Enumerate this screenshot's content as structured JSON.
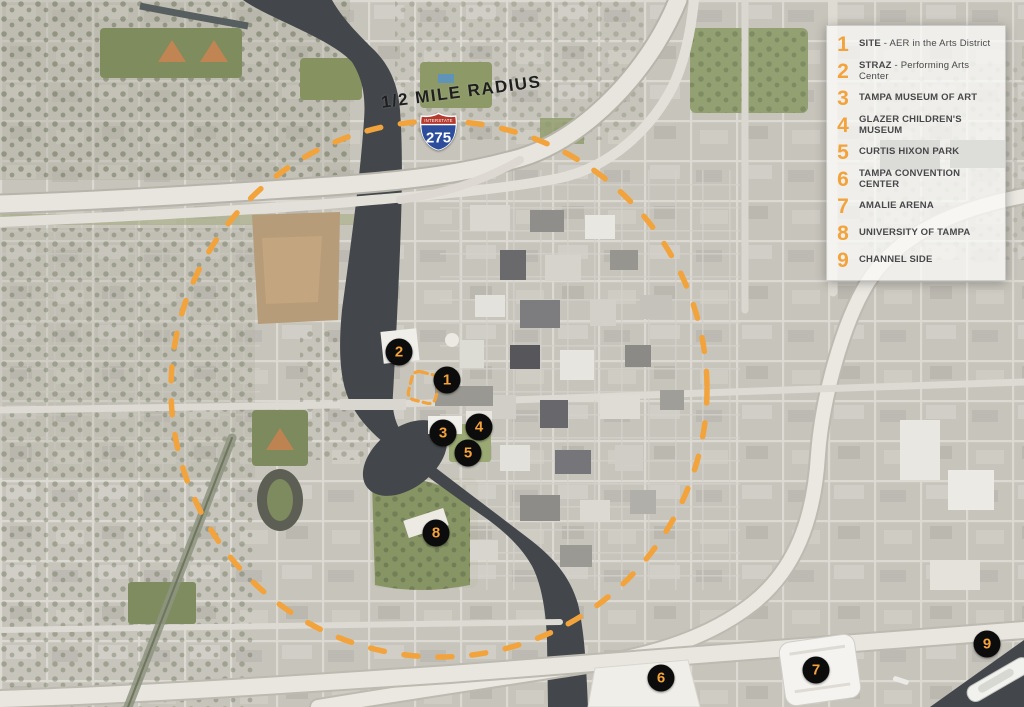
{
  "title": "Tampa downtown aerial context map - 1/2 mile radius site analysis",
  "colors": {
    "accent": "#F2A33C",
    "marker_background": "#0c0c0c",
    "water": "#43474b",
    "shield_red": "#b5392d",
    "shield_blue": "#2c4d9c",
    "legend_text": "#48484b"
  },
  "overlay": {
    "radius_label": "1/2 MILE RADIUS",
    "shield": {
      "top_text": "INTERSTATE",
      "number": "275"
    },
    "circle": {
      "cx": 439,
      "cy": 389,
      "r": 268,
      "color": "#F2A33C"
    },
    "site_box": {
      "x": 410,
      "y": 373,
      "w": 28,
      "h": 29,
      "rotation": 14,
      "color": "#F2A33C"
    }
  },
  "markers": [
    {
      "n": "1",
      "x": 447,
      "y": 380
    },
    {
      "n": "2",
      "x": 399,
      "y": 352
    },
    {
      "n": "3",
      "x": 443,
      "y": 433
    },
    {
      "n": "4",
      "x": 479,
      "y": 427
    },
    {
      "n": "5",
      "x": 468,
      "y": 453
    },
    {
      "n": "6",
      "x": 661,
      "y": 678
    },
    {
      "n": "7",
      "x": 816,
      "y": 670
    },
    {
      "n": "8",
      "x": 436,
      "y": 533
    },
    {
      "n": "9",
      "x": 987,
      "y": 644
    }
  ],
  "legend": {
    "items": [
      {
        "number": "1",
        "strong": "SITE",
        "rest": " - AER in the Arts District"
      },
      {
        "number": "2",
        "strong": "STRAZ",
        "rest": " - Performing Arts Center"
      },
      {
        "number": "3",
        "strong": "TAMPA MUSEUM OF ART",
        "rest": ""
      },
      {
        "number": "4",
        "strong": "GLAZER CHILDREN'S MUSEUM",
        "rest": ""
      },
      {
        "number": "5",
        "strong": "CURTIS HIXON PARK",
        "rest": ""
      },
      {
        "number": "6",
        "strong": "TAMPA CONVENTION CENTER",
        "rest": ""
      },
      {
        "number": "7",
        "strong": "AMALIE ARENA",
        "rest": ""
      },
      {
        "number": "8",
        "strong": "UNIVERSITY OF TAMPA",
        "rest": ""
      },
      {
        "number": "9",
        "strong": "CHANNEL SIDE",
        "rest": ""
      }
    ]
  }
}
